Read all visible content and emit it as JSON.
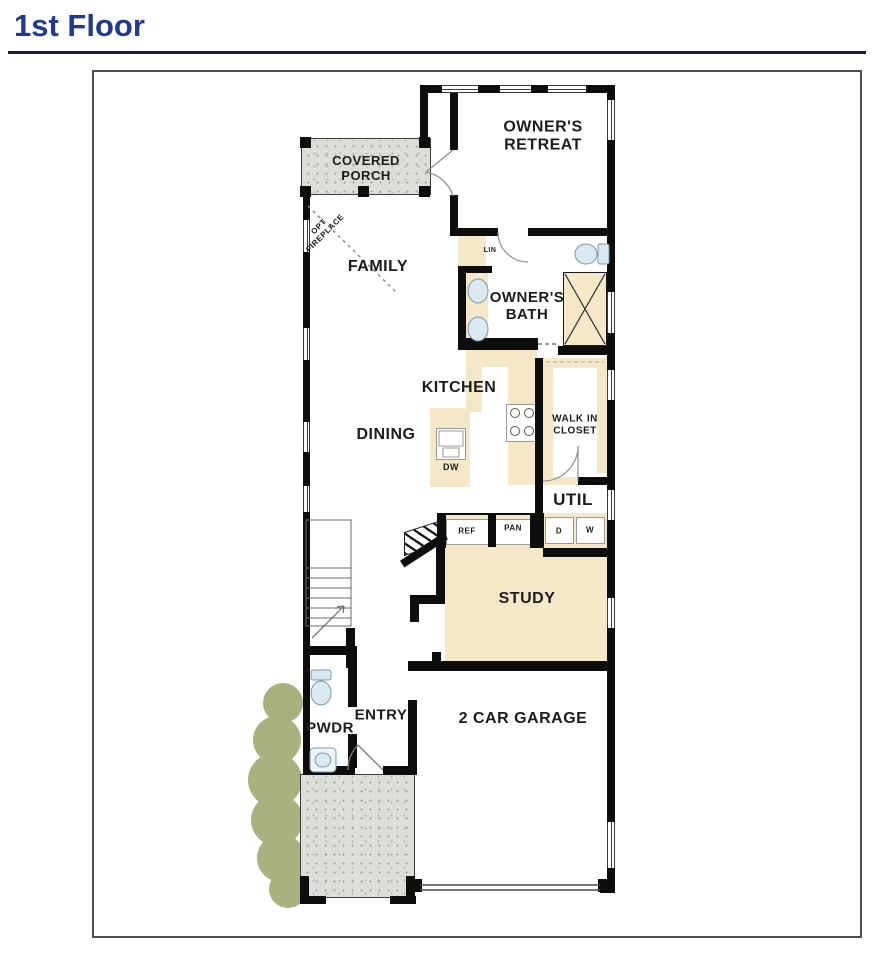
{
  "header": {
    "title": "1st Floor"
  },
  "colors": {
    "title_navy": "#213a8f",
    "wall_black": "#0d0d0d",
    "room_tan": "#f5e8c8",
    "porch_gray": "#dcded9",
    "bush_green": "#a9b27f",
    "fixture_blue": "#d9e8f1"
  },
  "floorplan": {
    "labels": {
      "covered_porch": "COVERED\nPORCH",
      "owners_retreat": "OWNER'S\nRETREAT",
      "opt_fireplace": "OPT\nFIREPLACE",
      "family": "FAMILY",
      "lin": "LIN",
      "owners_bath": "OWNER'S\nBATH",
      "kitchen": "KITCHEN",
      "dining": "DINING",
      "dw": "DW",
      "walk_in_closet": "WALK IN\nCLOSET",
      "util": "UTIL",
      "dryer": "D",
      "washer": "W",
      "ref": "REF",
      "pan": "PAN",
      "study": "STUDY",
      "pwdr": "PWDR",
      "entry": "ENTRY",
      "garage": "2 CAR GARAGE"
    },
    "fixtures": [
      "toilet",
      "sink",
      "shower",
      "cooktop",
      "dishwasher",
      "stairs",
      "door-swing",
      "washer-dryer",
      "refrigerator-niche",
      "pantry-niche",
      "bushes",
      "garage-door",
      "windows",
      "optional-fireplace-line"
    ]
  }
}
